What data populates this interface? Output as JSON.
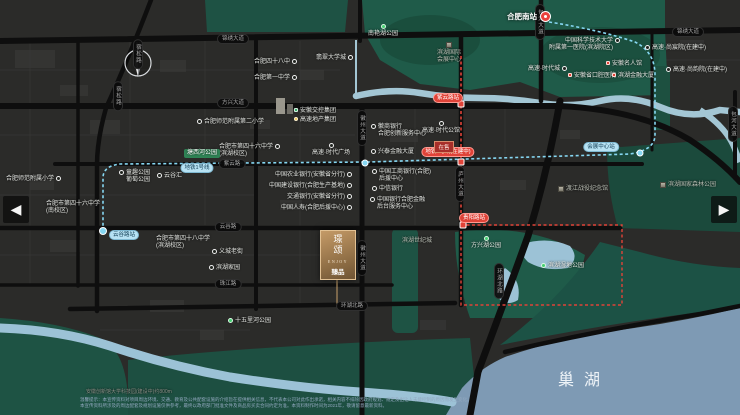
{
  "lake": {
    "label": "巢湖"
  },
  "compass": {
    "label": "N"
  },
  "nav": {
    "left_arrow": "◀",
    "right_arrow": "▶"
  },
  "station": {
    "label": "合肥南站"
  },
  "logo": {
    "vertical_text": "璟颂",
    "latin": "ENJOY",
    "sub": "臻品"
  },
  "sales_marker": {
    "label": "在售"
  },
  "disclaimer": {
    "line1": "温馨提示：本宣传资料对项目周边环境、交通、教育及公共配套设施的介绍旨在提供相关信息，不代表本公司对此作出承诺，相关内容不排除因政府规划、规定及出让人未能控制的原因而发生变化。",
    "line2": "本宣传资料所涉及的周边配套及规划设施仅供参考，最终以政府部门批准文件及商品房买卖合同约定为准。本资料制作时间为2021年，敬请留意最新资料。"
  },
  "colors": {
    "park_green": "#1f5b49",
    "water_blue": "#7e9ab4",
    "metro_cyan": "#86d7f2",
    "metro_red": "#e04338",
    "road_black": "#0e0e0e",
    "logo_bronze": "#b08a5a"
  },
  "pois": [
    {
      "id": "poi-nanyanhu-park",
      "label": "南艳湖公园",
      "x": 383,
      "y": 24,
      "icon": "park-dot",
      "stack": true
    },
    {
      "id": "poi-school-48",
      "label": "合肥四十八中",
      "x": 254,
      "y": 59,
      "icon": "circle",
      "iconSide": "right"
    },
    {
      "id": "poi-school-no1",
      "label": "合肥第一中学",
      "x": 254,
      "y": 75,
      "icon": "circle",
      "iconSide": "right"
    },
    {
      "id": "poi-university-town",
      "label": "翡翠大学城",
      "x": 316,
      "y": 55,
      "icon": "circle",
      "iconSide": "right"
    },
    {
      "id": "poi-ustc-hospital",
      "lines": [
        "中国科学技术大学",
        "附属第一医院(滨湖院区)"
      ],
      "x": 620,
      "y": 38,
      "icon": "circle",
      "iconSide": "right",
      "align": "right"
    },
    {
      "id": "poi-gaosu-shangchenyuan",
      "label": "高速·尚宸院(在建中)",
      "x": 645,
      "y": 45,
      "icon": "circle",
      "iconSide": "left"
    },
    {
      "id": "poi-gaosu-times-city",
      "label": "高速·时代城",
      "x": 528,
      "y": 66,
      "icon": "circle",
      "iconSide": "right"
    },
    {
      "id": "poi-gaosu-shangyunyuan",
      "label": "高速·尚韵院(在建中)",
      "x": 666,
      "y": 67,
      "icon": "circle",
      "iconSide": "left"
    },
    {
      "id": "poi-convention-center",
      "lines": [
        "滨湖国际",
        "会展中心"
      ],
      "x": 449,
      "y": 42,
      "icon": "building",
      "stack": true,
      "cls": "muted"
    },
    {
      "id": "poi-mingrenguan",
      "label": "安徽名人馆",
      "x": 606,
      "y": 61,
      "icon": "red-square",
      "iconSide": "left"
    },
    {
      "id": "poi-stomatology-hospital",
      "label": "安徽省口腔医院",
      "x": 568,
      "y": 73,
      "icon": "red-square",
      "iconSide": "left"
    },
    {
      "id": "poi-binhu-financial-tower",
      "label": "滨湖金融大厦",
      "x": 612,
      "y": 73,
      "icon": "red-square",
      "iconSide": "left"
    },
    {
      "id": "poi-gaosu-times-plaza",
      "label": "高速·时代广场",
      "x": 331,
      "y": 143,
      "icon": "circle",
      "stack": true
    },
    {
      "id": "poi-gaosu-times-mansion",
      "label": "高速·时代公馆",
      "x": 441,
      "y": 121,
      "icon": "circle",
      "stack": true
    },
    {
      "id": "poi-jiaokong-group",
      "label": "安徽交控集团",
      "x": 294,
      "y": 108,
      "icon": "green-sq",
      "iconSide": "left"
    },
    {
      "id": "poi-gaosu-realestate-group",
      "label": "高速地产集团",
      "x": 294,
      "y": 117,
      "icon": "yellow-dot",
      "iconSide": "left"
    },
    {
      "id": "poi-normal-school-2nd-primary",
      "label": "合肥师范附属第二小学",
      "x": 197,
      "y": 119,
      "icon": "circle",
      "iconSide": "left"
    },
    {
      "id": "poi-school-46-binhu",
      "lines": [
        "合肥市第四十六中学",
        "(滨湖校区)"
      ],
      "x": 219,
      "y": 144,
      "icon": "circle",
      "iconSide": "right"
    },
    {
      "id": "poi-tangxihe-park",
      "label": "塘西河公园",
      "x": 184,
      "y": 149,
      "icon": "none",
      "cls": "green-box"
    },
    {
      "id": "poi-putao-park",
      "lines": [
        "童趣公园",
        "葡萄公园"
      ],
      "x": 119,
      "y": 170,
      "icon": "circle",
      "iconSide": "left"
    },
    {
      "id": "poi-yunguhui",
      "label": "云谷汇",
      "x": 157,
      "y": 173,
      "icon": "circle",
      "iconSide": "left"
    },
    {
      "id": "poi-normal-school-primary",
      "label": "合肥师范附属小学",
      "x": 6,
      "y": 176,
      "icon": "circle",
      "iconSide": "right"
    },
    {
      "id": "poi-school-46-south",
      "lines": [
        "合肥市第四十六中学",
        "(南校区)"
      ],
      "x": 46,
      "y": 201,
      "icon": "none"
    },
    {
      "id": "poi-school-48-binhu",
      "lines": [
        "合肥市第四十八中学",
        "(滨湖校区)"
      ],
      "x": 156,
      "y": 236,
      "icon": "none"
    },
    {
      "id": "poi-abc-bank",
      "label": "中国农业银行(安徽省分行)",
      "x": 352,
      "y": 172,
      "icon": "circle",
      "iconSide": "right",
      "align": "right"
    },
    {
      "id": "poi-ccb-bank",
      "label": "中国建设银行(合肥生产基地)",
      "x": 352,
      "y": 183,
      "icon": "circle",
      "iconSide": "right",
      "align": "right"
    },
    {
      "id": "poi-bocom-bank",
      "label": "交通银行(安徽省分行)",
      "x": 352,
      "y": 194,
      "icon": "circle",
      "iconSide": "right",
      "align": "right"
    },
    {
      "id": "poi-chinalife",
      "label": "中国人寿(合肥后援中心)",
      "x": 352,
      "y": 205,
      "icon": "circle",
      "iconSide": "right",
      "align": "right"
    },
    {
      "id": "poi-icbc",
      "lines": [
        "中国工商银行(合肥)",
        "后援中心"
      ],
      "x": 372,
      "y": 169,
      "icon": "circle",
      "iconSide": "left"
    },
    {
      "id": "poi-citic-bank",
      "label": "中信银行",
      "x": 372,
      "y": 186,
      "icon": "circle",
      "iconSide": "left"
    },
    {
      "id": "poi-boc",
      "lines": [
        "中国银行合肥金融",
        "后台服务中心"
      ],
      "x": 370,
      "y": 197,
      "icon": "circle",
      "iconSide": "left"
    },
    {
      "id": "poi-huishang-bank",
      "lines": [
        "徽商银行",
        "合肥创新服务中心"
      ],
      "x": 371,
      "y": 124,
      "icon": "circle",
      "iconSide": "left"
    },
    {
      "id": "poi-xingtai-tower",
      "label": "兴泰金融大厦",
      "x": 371,
      "y": 149,
      "icon": "circle",
      "iconSide": "left"
    },
    {
      "id": "poi-binhu-century-city",
      "label": "滨湖世纪城",
      "x": 402,
      "y": 238,
      "icon": "none",
      "cls": "muted"
    },
    {
      "id": "poi-yicheng-old-street",
      "label": "义城老街",
      "x": 212,
      "y": 249,
      "icon": "circle",
      "iconSide": "left"
    },
    {
      "id": "poi-binhu-jiayuan",
      "label": "滨湖家园",
      "x": 209,
      "y": 265,
      "icon": "circle",
      "iconSide": "left"
    },
    {
      "id": "poi-shiwulihe-park",
      "label": "十五里河公园",
      "x": 228,
      "y": 318,
      "icon": "park-dot",
      "iconSide": "left"
    },
    {
      "id": "poi-fangxinghu-park",
      "label": "方兴湖公园",
      "x": 486,
      "y": 236,
      "icon": "park-dot",
      "stack": true
    },
    {
      "id": "poi-wetland-park",
      "label": "滨湖湿地公园",
      "x": 541,
      "y": 263,
      "icon": "park-dot",
      "iconSide": "left"
    },
    {
      "id": "poi-dujiang-memorial",
      "label": "渡江战役纪念馆",
      "x": 558,
      "y": 186,
      "icon": "building",
      "iconSide": "left",
      "cls": "muted"
    },
    {
      "id": "poi-forest-park",
      "label": "滨湖国家森林公园",
      "x": 660,
      "y": 182,
      "icon": "building",
      "iconSide": "left",
      "cls": "muted"
    },
    {
      "id": "poi-tech-park-note",
      "label": "安徽创新馆大学科技园(建设中)约800m",
      "x": 86,
      "y": 389,
      "icon": "none",
      "cls": "muted-dark"
    }
  ],
  "road_labels": [
    {
      "t": "锦绣大道",
      "x": 233,
      "y": 39
    },
    {
      "t": "锦绣大道",
      "x": 688,
      "y": 32
    },
    {
      "t": "方兴大道",
      "x": 233,
      "y": 103
    },
    {
      "t": "紫云路",
      "x": 232,
      "y": 164
    },
    {
      "t": "云谷路",
      "x": 228,
      "y": 227
    },
    {
      "t": "珠江路",
      "x": 228,
      "y": 284
    },
    {
      "t": "环湖北路",
      "x": 352,
      "y": 306
    },
    {
      "t": "宿松路",
      "x": 138,
      "y": 54,
      "v": true
    },
    {
      "t": "宿松路",
      "x": 118,
      "y": 96,
      "v": true
    },
    {
      "t": "徽州大道",
      "x": 362,
      "y": 128,
      "v": true
    },
    {
      "t": "徽州大道",
      "x": 362,
      "y": 258,
      "v": true
    },
    {
      "t": "庐州大道",
      "x": 460,
      "y": 184,
      "v": true
    },
    {
      "t": "包河大道",
      "x": 540,
      "y": 22,
      "v": true
    },
    {
      "t": "包河大道",
      "x": 733,
      "y": 124,
      "v": true
    },
    {
      "t": "环湖北路",
      "x": 499,
      "y": 281,
      "v": true
    }
  ],
  "metro_labels": [
    {
      "t": "地铁1号线",
      "x": 197,
      "y": 168,
      "c": "cyan"
    },
    {
      "t": "云谷路站",
      "x": 124,
      "y": 235,
      "c": "cyan"
    },
    {
      "t": "会展中心站",
      "x": 601,
      "y": 147,
      "c": "cyan"
    },
    {
      "t": "紫云路站",
      "x": 448,
      "y": 98,
      "c": "red"
    },
    {
      "t": "地铁5号线(在建中)",
      "x": 448,
      "y": 152,
      "c": "red"
    },
    {
      "t": "贵阳路站",
      "x": 474,
      "y": 218,
      "c": "red"
    }
  ]
}
